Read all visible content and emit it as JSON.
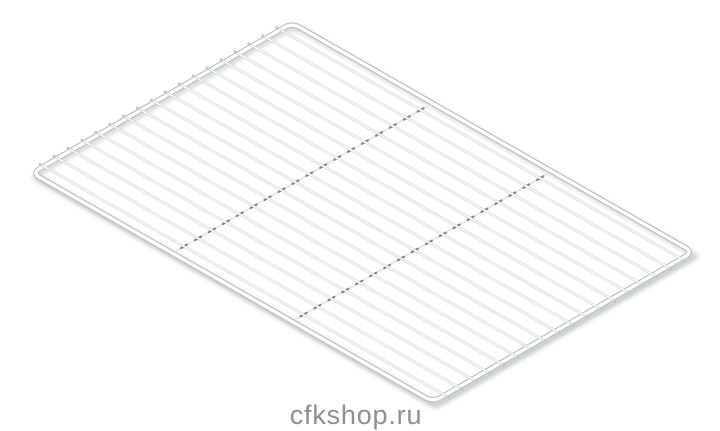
{
  "page": {
    "background": "#ffffff",
    "width": 720,
    "height": 431
  },
  "watermark": {
    "text": "cfkshop.ru",
    "color": "#8f8f8f"
  },
  "product_image": {
    "name": "wire-grid-shelf",
    "description": "White chrome-plated wire grid shelf rack shown in isometric view on a white background",
    "grid": {
      "corners": {
        "top": [
          292,
          23
        ],
        "right": [
          693,
          252
        ],
        "bottom": [
          433,
          402
        ],
        "left": [
          32,
          173
        ]
      },
      "corner_radius": 9,
      "wire_count": 18,
      "wire_margin": 0.045,
      "support_bars_u": [
        0.35,
        0.648
      ],
      "colors": {
        "wire_fill": "#ffffff",
        "wire_outline": "#c2c7ca",
        "frame_fill": "#ffffff",
        "frame_outline": "#b8bec1",
        "weld_tick": "#7f868b",
        "support_bar": "#e6e9ea",
        "shadow": "#cbd0d3",
        "ground_shadow": "#c3c8cb"
      }
    }
  }
}
